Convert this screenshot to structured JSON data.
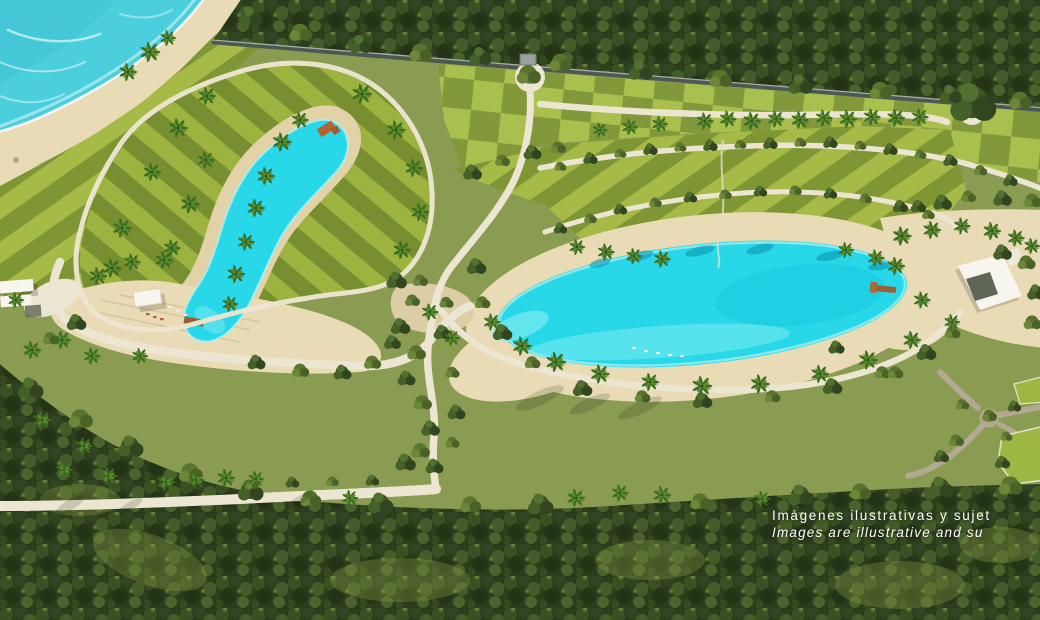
{
  "meta": {
    "type": "aerial-3d-masterplan-render",
    "description": "Aerial render of a beachfront resort community with two turquoise crystal lagoons, striped lawns, palm trees, jungle and an ocean beach"
  },
  "disclaimer": {
    "line1": "Imágenes ilustrativas y sujet",
    "line2": "Images are illustrative and su"
  },
  "palette": {
    "ocean": "#4ccfdc",
    "ocean_deep": "#3bbfd2",
    "foam": "#ffffff",
    "sand": "#e8dbb5",
    "lagoon": "#28d8e9",
    "lagoon_shallow": "#8beef1",
    "lagoon_deep": "#12c2d9",
    "lawn": "#8a9b52",
    "lawn_stripe_light": "#a6ba48",
    "lawn_stripe_dark": "#7e9634",
    "forest": "#2c3d1b",
    "path": "#ece5d1",
    "road_gray": "#b3a992",
    "wall": "#4d5754",
    "wood": "#9a5f33",
    "roof_white": "#f7f5ee",
    "text": "#ffffff"
  },
  "features": [
    "ocean with surf",
    "sandy beach",
    "beachfront striped lawns",
    "perimeter wall and jungle forest",
    "elongated crystal lagoon with beach club, cabana and piers",
    "large oval crystal lagoon with sun loungers and pier",
    "white clubhouse buildings",
    "palm-lined walking paths and roundabouts",
    "winding tree-lined road",
    "perimeter road through jungle",
    "residential lawn parcels"
  ]
}
